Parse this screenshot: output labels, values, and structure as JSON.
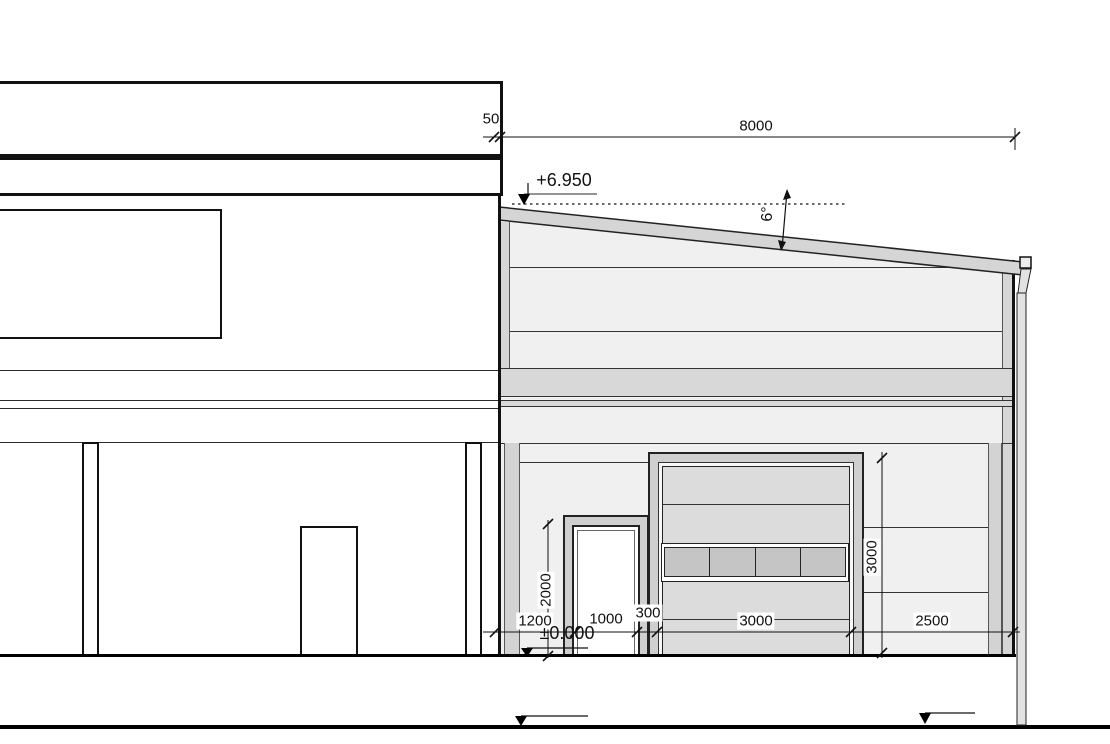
{
  "dims": {
    "gap": "50",
    "building_width": "8000",
    "seg_wall": "1200",
    "seg_door": "1000",
    "seg_pier": "300",
    "seg_garage": "3000",
    "seg_right": "2500",
    "door_height": "2000",
    "garage_height": "3000"
  },
  "levels": {
    "roof": "+6.950",
    "floor": "±0.000"
  },
  "angles": {
    "roof_slope": "6°"
  },
  "colors": {
    "line": "#111111",
    "facade": "#f0f0f0",
    "band": "#d8d8d8",
    "trim": "#d6d6d6",
    "pilaster": "#d3d3d3",
    "frame": "#cfcfcf",
    "roof_band": "#d5d5d5",
    "garage_leaf": "#dcdcdc",
    "window_pane": "#c5c5c5"
  }
}
